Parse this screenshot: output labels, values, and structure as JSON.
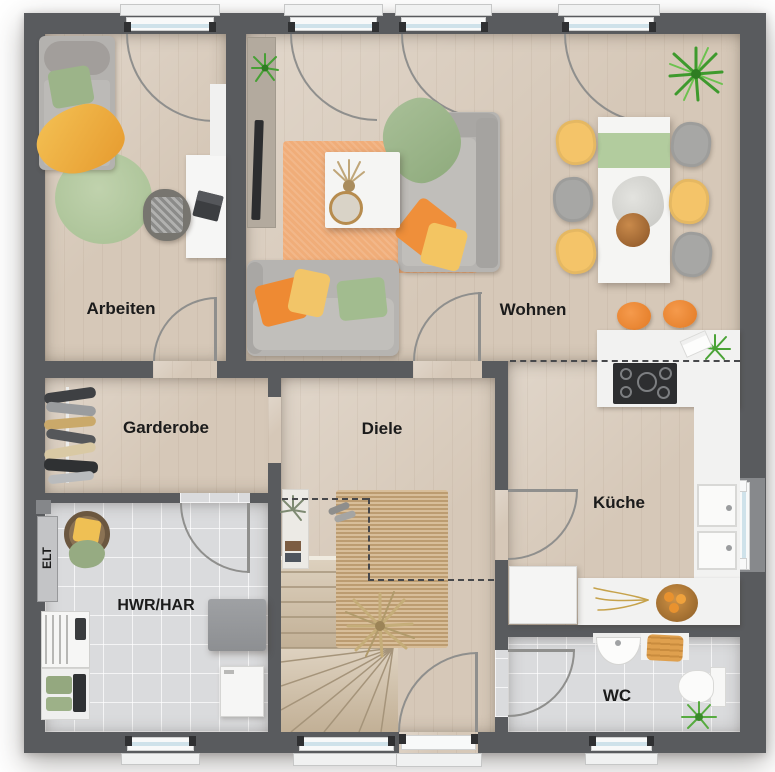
{
  "floorplan": {
    "type": "residential-ground-floor-plan-top-view",
    "rooms": [
      {
        "id": "arbeiten",
        "label": "Arbeiten"
      },
      {
        "id": "wohnen",
        "label": "Wohnen"
      },
      {
        "id": "garderobe",
        "label": "Garderobe"
      },
      {
        "id": "diele",
        "label": "Diele"
      },
      {
        "id": "kueche",
        "label": "Küche"
      },
      {
        "id": "hwr",
        "label": "HWR/HAR"
      },
      {
        "id": "wc",
        "label": "WC"
      },
      {
        "id": "elt",
        "label": "ELT"
      }
    ],
    "colors": {
      "wall": "#595b5e",
      "wood_floor": "#d6c8b8",
      "tile_floor": "#dadbdd",
      "counter_white": "#f2f2f1",
      "accent_orange": "#ee8a35",
      "accent_yellow": "#f2c364",
      "accent_green": "#a9c295",
      "rug_orange": "#f0ad79",
      "rug_jute": "#cbaa7e",
      "window_glass": "#cfe2ea",
      "label_text": "#1b1b1b"
    }
  }
}
